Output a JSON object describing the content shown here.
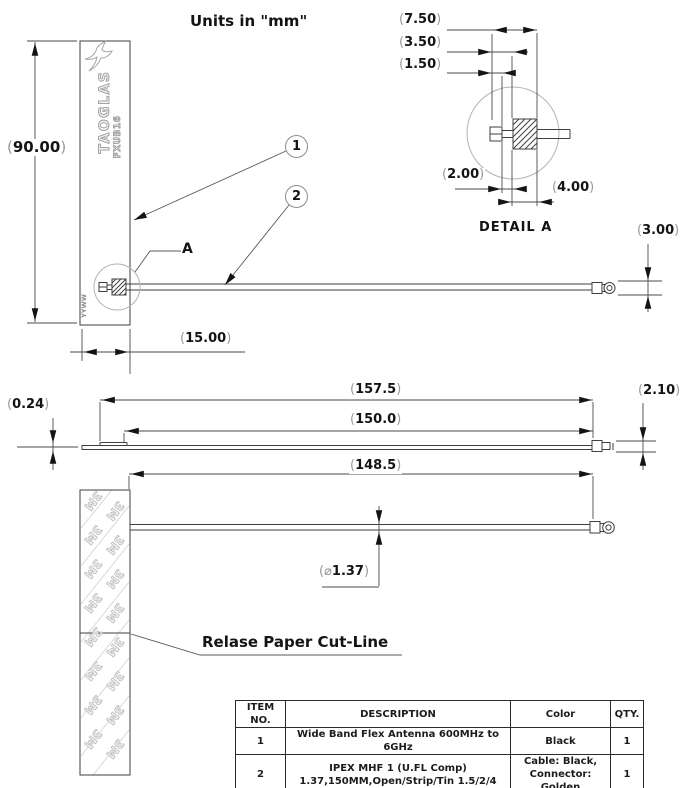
{
  "page": {
    "units_note": "Units in \"mm\""
  },
  "symbols": {
    "open": "(",
    "close": ")",
    "diameter": "⌀"
  },
  "front_view": {
    "height": "90.00",
    "width": "15.00",
    "brand": "TAOGLAS",
    "model": "FXUB16",
    "date_code": "YYWW",
    "balloon_1": "1",
    "balloon_2": "2",
    "detail_ref": "A",
    "connector_height": "3.00"
  },
  "detail_a": {
    "title": "DETAIL A",
    "dim_7_50": "7.50",
    "dim_3_50": "3.50",
    "dim_1_50": "1.50",
    "dim_2_00": "2.00",
    "dim_4_00": "4.00"
  },
  "side_view": {
    "thickness": "0.24",
    "length_overall": "157.5",
    "length_cable": "150.0",
    "connector_height": "2.10"
  },
  "cable_view": {
    "length_exposed": "148.5",
    "cable_diameter": "1.37",
    "cutline_label": "Relase Paper Cut-Line",
    "watermark": "3M"
  },
  "bom_table": {
    "headers": [
      "ITEM NO.",
      "DESCRIPTION",
      "Color",
      "QTY."
    ],
    "rows": [
      {
        "item_no": "1",
        "description": "Wide Band Flex Antenna 600MHz to 6GHz",
        "color": "Black",
        "qty": "1"
      },
      {
        "item_no": "2",
        "description_line1": "IPEX MHF 1 (U.FL Comp)",
        "description_line2": "1.37,150MM,Open/Strip/Tin 1.5/2/4",
        "color_line1": "Cable: Black,",
        "color_line2": "Connector: Golden",
        "qty": "1"
      }
    ]
  },
  "colors": {
    "line": "#3f3f3f",
    "light_line": "#b3b3b3",
    "text": "#141414",
    "paren": "#9a9a9a"
  }
}
